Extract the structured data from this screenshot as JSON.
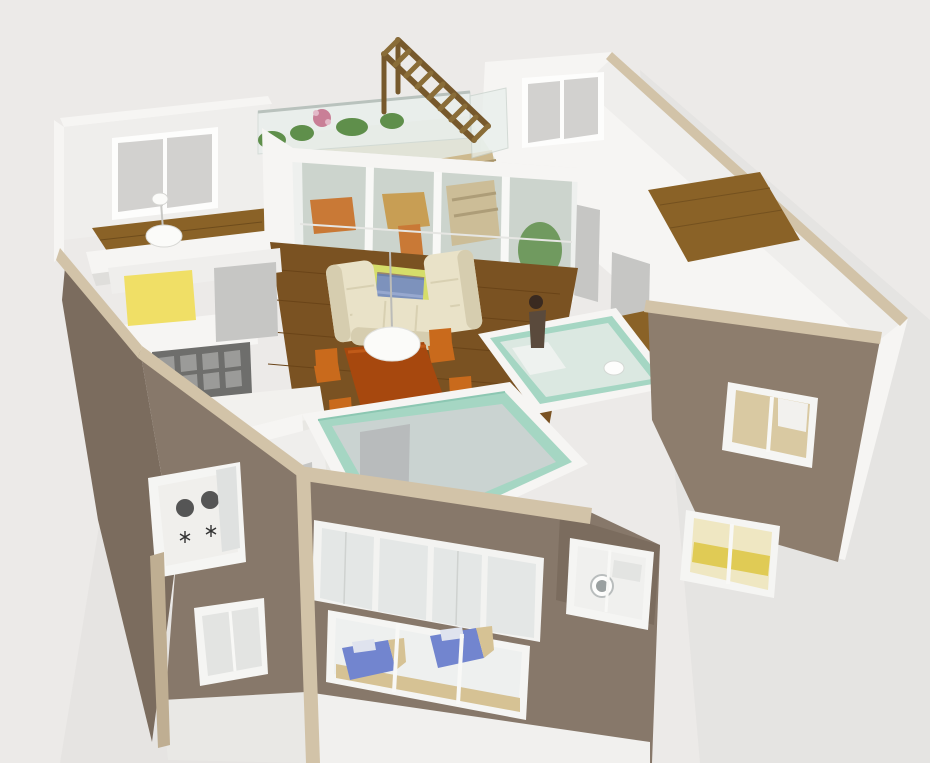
{
  "scene": {
    "description_names": [
      "3d-house-cutaway-render",
      "upper-floor-plan",
      "lower-floor-brick-facade",
      "bedroom-top-left",
      "balcony-with-plants",
      "wooden-staircase",
      "glass-door-wall",
      "living-room",
      "dining-set",
      "kitchen",
      "bathroom-glass-room",
      "entry-glass-room",
      "bedrooms-right",
      "person-figure-kitchen",
      "person-figure-hall",
      "window-blue-beds",
      "window-washer",
      "window-yellow-bedroom",
      "window-stove"
    ]
  },
  "palette": {
    "background": "#eceae8",
    "shadow": "#e0dedc",
    "wall_white": "#f6f5f3",
    "wall_light": "#efeeec",
    "wall_shade": "#dfdedb",
    "wall_dark": "#d2d1cf",
    "trim_beige": "#d2c3a8",
    "trim_beige_dark": "#bfae92",
    "brick": "#87786a",
    "brick_dark": "#7b6c5e",
    "brick_light": "#8d7d6d",
    "wood": "#8a6227",
    "wood_dark": "#6e4c1c",
    "wood_living": "#7a5222",
    "stair_wood": "#8a6d38",
    "stair_wood_dark": "#77592c",
    "mint": "#a5d6c3",
    "glass_interior": "#dfe9e4",
    "glass_pane": "#ccd4cd",
    "glaze_pane": "#e4e7e6",
    "sofa": "#e9e2c8",
    "sofa_shadow": "#d6cdaf",
    "rug_blue": "#4a66a0",
    "rug_blue_light": "#7288bd",
    "table_rust": "#a7480e",
    "chair_orange": "#c96a1c",
    "coffee_frame": "#d5dd6a",
    "yellow_box": "#f0df66",
    "yellow_glow": "#e0cb55",
    "bed_blue": "#7285cf",
    "plant_green": "#5f8f4b",
    "flower_pink": "#c97f97",
    "lamp_white": "#fbfbf9",
    "tv_dark": "#3c4448",
    "gray_door": "#c6c6c4",
    "gray_floor": "#ccd3d2",
    "cabinet_gray": "#6e6e6c",
    "tile_floor": "#e8e7e3",
    "golden_room": "#d9c9a2",
    "tan_shelf": "#d6c294",
    "hair_dark": "#5a3a30",
    "shirt_teal": "#9fc6c0"
  }
}
